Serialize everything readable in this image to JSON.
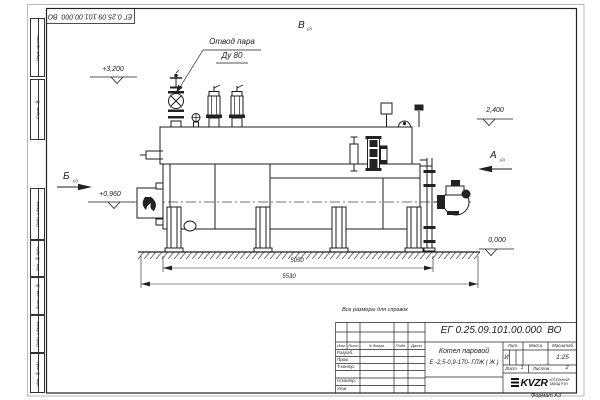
{
  "sheet": {
    "corner_designation": "ЕГ 0.25.09.101.00.000  ВО",
    "note": "Все размеры для справок",
    "format_note": "Формат А3",
    "margin_stamps": {
      "perv": "Перв. примен.",
      "sprav": "Справ. №",
      "podp1": "Подп. и дата",
      "inv_dubl": "Инв. № дубл.",
      "vzam": "Взам. инв. №",
      "podp2": "Подп. и дата",
      "inv_podl": "Инв. № подл."
    }
  },
  "drawing": {
    "steam_outlet_label": "Отвод пара",
    "steam_outlet_dn": "Ду 80",
    "view_top": "В",
    "view_top_ref": "(2)",
    "section_left": "Б",
    "section_left_ref": "(2)",
    "view_right": "А",
    "view_right_ref": "(2)",
    "elevations": {
      "top": "+3,200",
      "burner": "+0,960",
      "right": "2,400",
      "ground": "0,000"
    },
    "dimensions": {
      "inner": "5050",
      "overall": "5530"
    }
  },
  "title_block": {
    "designation": "ЕГ 0.25.09.101.00.000  ВО",
    "product_name_line1": "Котел паровой",
    "product_name_line2": "Е -2,5-0,9-170- ГЛЖ ( Ж )",
    "header_cols": {
      "izm": "Изм",
      "list": "Лист",
      "doc": "N докум.",
      "podp": "Подп.",
      "date": "Дата"
    },
    "sign_rows": [
      "Разраб.",
      "Пров.",
      "Т.контр.",
      "Н.контр.",
      "Утв."
    ],
    "lit_label": "Лит.",
    "mass_label": "Масса",
    "scale_label": "Масштаб",
    "lit_value": "И",
    "scale_value": "1:25",
    "sheet_label": "Лист",
    "sheet_value": "1",
    "sheets_label": "Листов",
    "sheets_value": "2",
    "company": {
      "logo": "KVZR",
      "line1": "КОТЕЛЬНЫЙ",
      "line2": "ЗАВОД РЭП"
    }
  }
}
